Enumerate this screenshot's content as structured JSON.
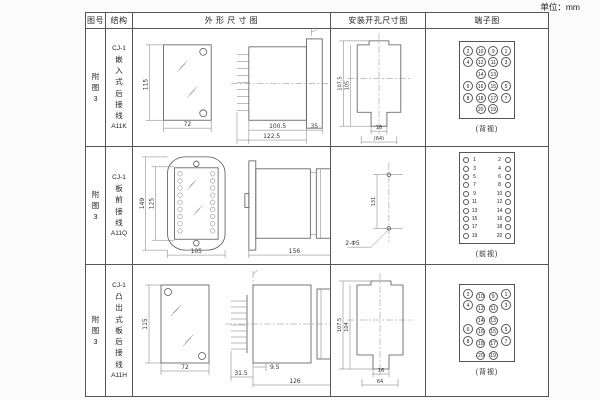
{
  "page": {
    "unit_label": "单位：mm"
  },
  "headers": {
    "fig": "图号",
    "structure": "结构",
    "outline": "外 形 尺 寸 图",
    "install": "安装开孔尺寸图",
    "terminal": "端子图"
  },
  "rows": [
    {
      "fig": "附图3",
      "model": "CJ-1",
      "mount_name": "嵌入式后接线",
      "code": "A11K",
      "outline": {
        "front_h": "115",
        "front_w": "72",
        "side_body": "100.5",
        "side_total": "122.5",
        "side_flange": "35"
      },
      "install": {
        "outer_h": "107.5",
        "inner_h": "105",
        "slot_w": "16",
        "bottom_w": "(64)"
      },
      "terminal": {
        "caption": "(背视)",
        "grid": [
          [
            "2",
            "10",
            "9",
            "1"
          ],
          [
            "4",
            "12",
            "11",
            "3"
          ],
          [
            "",
            "14",
            "13",
            ""
          ],
          [
            "6",
            "16",
            "15",
            "5"
          ],
          [
            "8",
            "18",
            "17",
            "7"
          ],
          [
            "",
            "20",
            "19",
            ""
          ]
        ]
      }
    },
    {
      "fig": "附图3",
      "model": "CJ-1",
      "mount_name": "板前接线",
      "code": "A11Q",
      "outline": {
        "front_h_outer": "149",
        "front_h_inner": "125",
        "front_w": "105",
        "side_len": "156",
        "side_h": "115"
      },
      "install": {
        "hole_spacing": "131",
        "holes": "2-Φ5"
      },
      "terminal": {
        "caption": "(前视)",
        "left": [
          "1",
          "3",
          "5",
          "7",
          "9",
          "11",
          "13",
          "15",
          "17",
          "19"
        ],
        "right": [
          "2",
          "4",
          "6",
          "8",
          "10",
          "12",
          "14",
          "16",
          "18",
          "20"
        ]
      }
    },
    {
      "fig": "附图3",
      "model": "CJ-1",
      "mount_name": "凸出式板后接线",
      "code": "A11H",
      "outline": {
        "front_h": "115",
        "front_w": "72",
        "side_a": "31.5",
        "side_b": "9.5",
        "side_len": "126"
      },
      "install": {
        "outer_h": "107.5",
        "inner_h": "104",
        "slot_w": "16",
        "bottom_w": "64"
      },
      "terminal": {
        "caption": "(背视)",
        "grid": [
          [
            "2",
            "10",
            "9",
            "1"
          ],
          [
            "4",
            "12",
            "11",
            "3"
          ],
          [
            "",
            "14",
            "13",
            ""
          ],
          [
            "6",
            "16",
            "15",
            "5"
          ],
          [
            "8",
            "18",
            "17",
            "7"
          ],
          [
            "",
            "20",
            "19",
            ""
          ]
        ]
      }
    }
  ]
}
